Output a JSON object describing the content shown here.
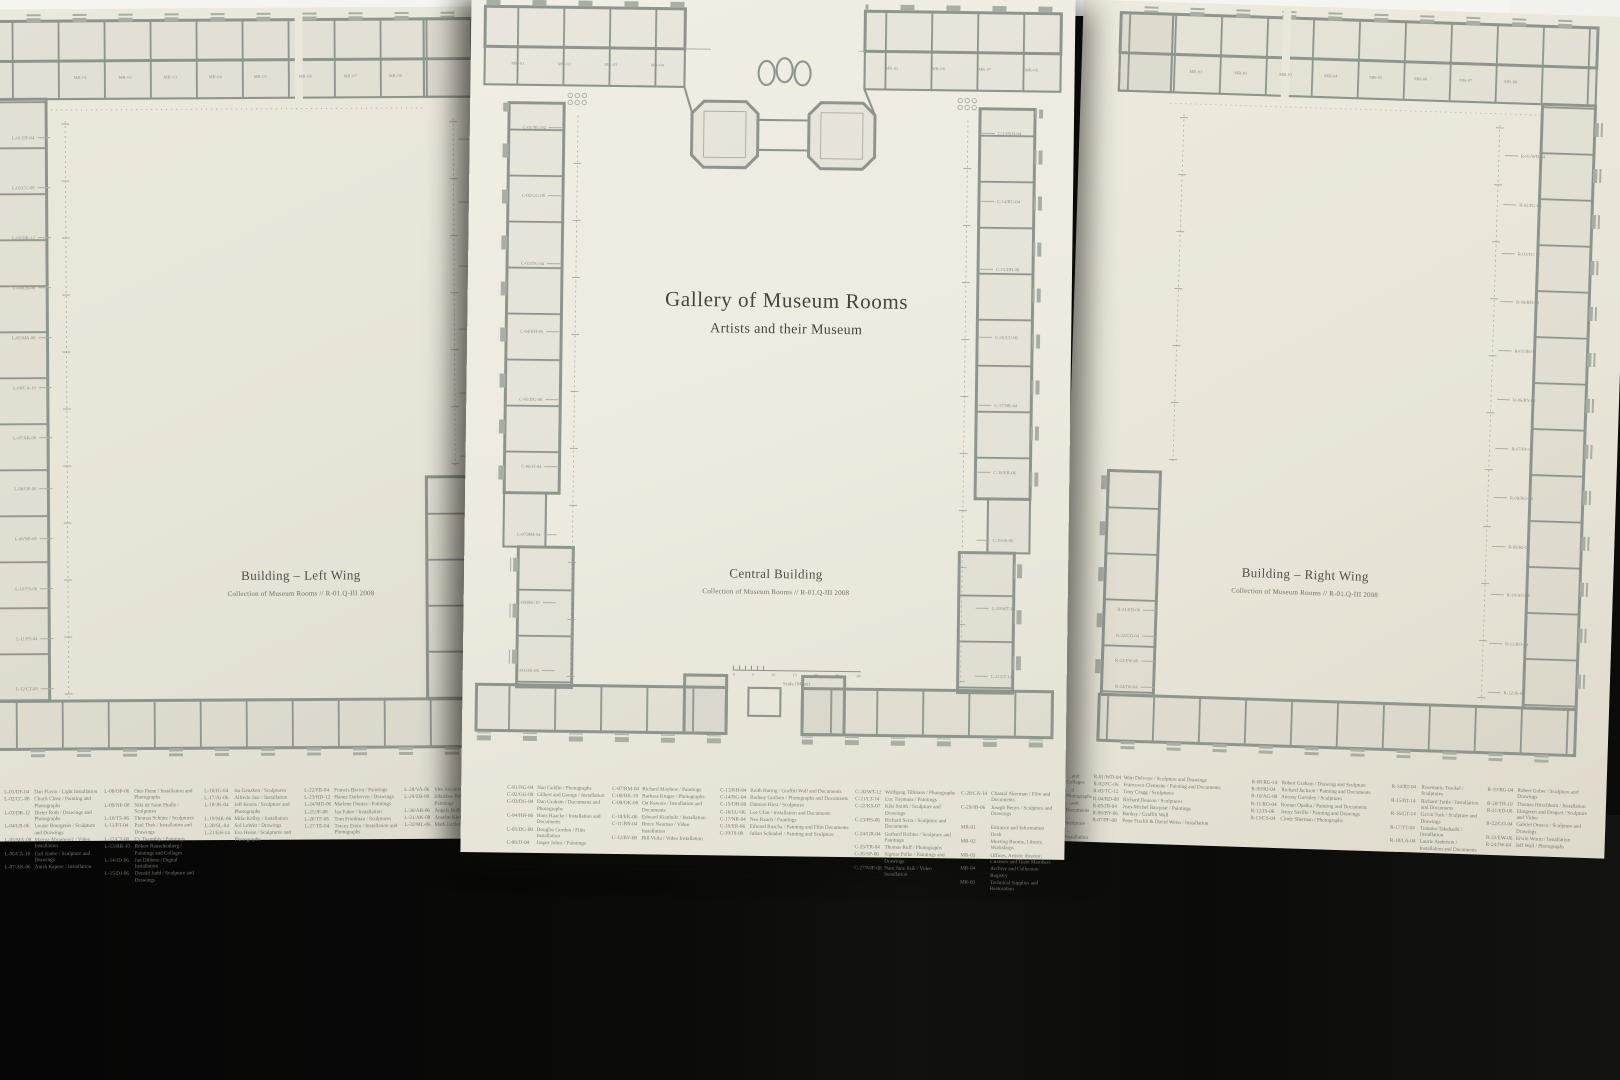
{
  "poster": {
    "title": "Gallery of Museum Rooms",
    "subtitle": "Artists and their Museum"
  },
  "sheets": {
    "left": {
      "caption": "Building – Left Wing",
      "subcaption": "Collection of Museum Rooms // R-01.Q-III 2008",
      "room_labels": [
        "MR-01",
        "MR-02",
        "MR-03",
        "MR-04",
        "MR-05",
        "MR-06",
        "MR-07",
        "MR-08"
      ],
      "edge_labels_left": [
        "L-01/DF-04",
        "L-02/CC-08",
        "L-03/DR-12",
        "L-04/LB-06",
        "L-05/MA-08",
        "L-06/CA-10",
        "L-07/AK-06",
        "L-08/OP-06",
        "L-09/NP-08",
        "L-10/TS-06",
        "L-11/PT-04",
        "L-12/CT-08"
      ],
      "edge_labels_right": [
        "L-16/IG-04",
        "L-17/AJ-06",
        "L-18/JK-04",
        "L-19/MK-06",
        "L-20/SL-04",
        "L-21/EH-14"
      ],
      "legend": {
        "c1": [
          {
            "c": "L-01/DF-04",
            "t": "Dan Flavin / Light Installation"
          },
          {
            "c": "L-02/CC-08",
            "t": "Chuck Close / Painting and Photographs"
          },
          {
            "c": "L-03/DR-12",
            "t": "Dieter Roth / Drawings and Photographs"
          },
          {
            "c": "L-04/LB-06",
            "t": "Louise Bourgeois / Sculpture and Drawings"
          },
          {
            "c": "L-05/MA-08",
            "t": "Marina Abramović / Video Installation"
          },
          {
            "c": "L-06/CA-10",
            "t": "Carl Andre / Sculpture and Drawings"
          },
          {
            "c": "L-07/AK-06",
            "t": "Anish Kapoor / Installation"
          }
        ],
        "c2": [
          {
            "c": "L-08/OP-06",
            "t": "Otto Piene / Installation and Photographs"
          },
          {
            "c": "L-09/NP-08",
            "t": "Niki de Saint Phalle / Sculptures"
          },
          {
            "c": "L-10/TS-06",
            "t": "Thomas Schütte / Sculptures"
          },
          {
            "c": "L-11/PT-04",
            "t": "Paul Thek / Installation and Drawings"
          },
          {
            "c": "L-12/CT-08",
            "t": "Cy Twombly / Paintings"
          },
          {
            "c": "L-13/RR-10",
            "t": "Robert Rauschenberg / Paintings and Collages"
          },
          {
            "c": "L-14/JD-06",
            "t": "Jan Dibbets / Digital Installation"
          },
          {
            "c": "L-15/DJ-06",
            "t": "Donald Judd / Sculpture and Drawings"
          }
        ],
        "c3": [
          {
            "c": "L-16/IG-04",
            "t": "Isa Genzken / Sculptures"
          },
          {
            "c": "L-17/AJ-06",
            "t": "Alfredo Jaar / Installation"
          },
          {
            "c": "L-18/JK-04",
            "t": "Jeff Koons / Sculpture and Photographs"
          },
          {
            "c": "L-19/MK-06",
            "t": "Mike Kelley / Installation"
          },
          {
            "c": "L-20/SL-04",
            "t": "Sol LeWitt / Drawings"
          },
          {
            "c": "L-21/EH-14",
            "t": "Eva Hesse / Sculptures and Photographs"
          }
        ],
        "c4": [
          {
            "c": "L-22/FB-04",
            "t": "Francis Bacon / Paintings"
          },
          {
            "c": "L-23/HD-12",
            "t": "Hanne Darboven / Drawings"
          },
          {
            "c": "L-24/MD-06",
            "t": "Marlene Dumas / Paintings"
          },
          {
            "c": "L-25/JF-08",
            "t": "Jan Fabre / Installation"
          },
          {
            "c": "L-26/TF-06",
            "t": "Tom Friedman / Sculptures"
          },
          {
            "c": "L-27/TE-04",
            "t": "Tracey Emin / Installation and Photographs"
          }
        ],
        "c5": [
          {
            "c": "L-28/VA-06",
            "t": "Vito Acconci / Installation"
          },
          {
            "c": "L-29/ZB-08",
            "t": "Zdzislaw Beksinski / Paintings"
          },
          {
            "c": "L-30/AB-06",
            "t": "Angela Bulloch / Sculptures"
          },
          {
            "c": "L-31/AK-08",
            "t": "Anselm Kiefer / Paintings"
          },
          {
            "c": "L-32/ML-06",
            "t": "Mark Leckey / Installation"
          }
        ]
      }
    },
    "center": {
      "caption": "Central Building",
      "subcaption": "Collection of Museum Rooms // R-01.Q-III 2008",
      "room_labels_left": [
        "MR-01",
        "MR-02",
        "MR-03",
        "MR-04"
      ],
      "room_labels_right": [
        "MR-05",
        "MR-06",
        "MR-07",
        "MR-08"
      ],
      "edge_labels_left": [
        "C-01/NG-04",
        "C-02/GG-08",
        "C-03/DG-04",
        "C-04/HH-06",
        "C-05/DG-08",
        "C-06/JJ-04",
        "C-07/RM-04",
        "C-08/BK-10",
        "C-09/OK-06"
      ],
      "edge_labels_right": [
        "C-13/KH-04",
        "C-14/RG-04",
        "C-15/DH-08",
        "C-16/LU-06",
        "C-17/NR-04",
        "C-18/ER-06",
        "C-19/JS-06",
        "C-20/WT-12",
        "C-21/LT-14"
      ],
      "scale": {
        "label": "Scale (Meter)",
        "ticks": [
          "0",
          "5",
          "10",
          "15",
          "20",
          "30",
          "40"
        ]
      },
      "legend": {
        "c1": [
          {
            "c": "C-01/NG-04",
            "t": "Nan Goldin / Photographs"
          },
          {
            "c": "C-02/GG-08",
            "t": "Gilbert and George / Installation"
          },
          {
            "c": "C-03/DG-04",
            "t": "Dan Graham / Documents and Photographs"
          },
          {
            "c": "C-04/HH-06",
            "t": "Hans Haacke / Installation and Documents"
          },
          {
            "c": "C-05/DG-08",
            "t": "Douglas Gordon / Film Installation"
          },
          {
            "c": "C-06/JJ-04",
            "t": "Jasper Johns / Paintings"
          }
        ],
        "c2": [
          {
            "c": "C-07/RM-04",
            "t": "Richard Mayhew / Paintings"
          },
          {
            "c": "C-08/BK-10",
            "t": "Barbara Kruger / Photographs"
          },
          {
            "c": "C-09/OK-06",
            "t": "On Kawara / Installation and Documents"
          },
          {
            "c": "C-10/EK-06",
            "t": "Edward Kienholz / Installation"
          },
          {
            "c": "C-11/BN-04",
            "t": "Bruce Nauman / Video Installation"
          },
          {
            "c": "C-12/BV-08",
            "t": "Bill Viola / Video Installation"
          }
        ],
        "c3": [
          {
            "c": "C-13/KH-04",
            "t": "Keith Haring / Graffiti Wall and Documents"
          },
          {
            "c": "C-14/RG-04",
            "t": "Rodney Graham / Photographs and Documents"
          },
          {
            "c": "C-15/DH-08",
            "t": "Damien Hirst / Sculptures"
          },
          {
            "c": "C-16/LU-06",
            "t": "Lee Ufan / Installation and Documents"
          },
          {
            "c": "C-17/NR-04",
            "t": "Neo Rauch / Paintings"
          },
          {
            "c": "C-18/ER-06",
            "t": "Edward Ruscha / Painting and Film Documents"
          },
          {
            "c": "C-19/JS-06",
            "t": "Julian Schnabel / Painting and Sculpture"
          }
        ],
        "c4": [
          {
            "c": "C-20/WT-12",
            "t": "Wolfgang Tillmans / Photographs"
          },
          {
            "c": "C-21/LT-14",
            "t": "Luc Tuymans / Paintings"
          },
          {
            "c": "C-22/KS-07",
            "t": "Kiki Smith / Sculpture and Drawings"
          },
          {
            "c": "C-23/RS-06",
            "t": "Richard Serra / Sculpture and Documents"
          },
          {
            "c": "C-24/GR-04",
            "t": "Gerhard Richter / Sculpture and Paintings"
          },
          {
            "c": "C-25/TR-04",
            "t": "Thomas Ruff / Photographs"
          },
          {
            "c": "C-26/SP-06",
            "t": "Sigmar Polke / Paintings and Drawings"
          },
          {
            "c": "C-27/NJP-08",
            "t": "Nam June Paik / Video Installation"
          }
        ],
        "c5": [
          {
            "c": "C-28/CA-14",
            "t": "Chantal Akerman / Film and Documents"
          },
          {
            "c": "C-29/JB-06",
            "t": "Joseph Beuys / Sculpture and Drawings"
          },
          {
            "c": "",
            "t": ""
          },
          {
            "c": "MR-01",
            "t": "Entrance and Information Desk"
          },
          {
            "c": "MR-02",
            "t": "Meeting Rooms, Library, Workshops"
          },
          {
            "c": "MR-03",
            "t": "Offices, Artistic director, Curators and Team Members"
          },
          {
            "c": "MR-04",
            "t": "Archive and Collection Registry"
          },
          {
            "c": "MR-05",
            "t": "Technical Supplies and Restoration"
          }
        ]
      }
    },
    "right": {
      "caption": "Building – Right Wing",
      "subcaption": "Collection of Museum Rooms // R-01.Q-III 2008",
      "room_labels": [
        "MR-01",
        "MR-02",
        "MR-03",
        "MR-04",
        "MR-05",
        "MR-06",
        "MR-07",
        "MR-08"
      ],
      "edge_labels_right": [
        "R-01/WD-04",
        "R-02/FC-06",
        "R-03/TC-12",
        "R-04/RD-08",
        "R-05/JB-04",
        "R-06/BY-06",
        "R-07/PF-08",
        "R-08/RG-14",
        "R-09/RJ-04",
        "R-10/AG-08",
        "R-11/RO-04",
        "R-12/JS-06"
      ],
      "edge_labels_left": [
        "R-21/ED-06",
        "R-22/GO-04",
        "R-23/EW-06",
        "R-24/JW-04"
      ],
      "legend": {
        "c0": [
          "…and Collages",
          "…d Photographs",
          "…and Documents",
          "…Sculpture",
          "…Installation"
        ],
        "c1": [
          {
            "c": "R-01/WD-04",
            "t": "Wim Delvoye / Sculpture and Drawings"
          },
          {
            "c": "R-02/FC-06",
            "t": "Francesco Clemente / Painting and Documents"
          },
          {
            "c": "R-03/TC-12",
            "t": "Tony Cragg / Sculptures"
          },
          {
            "c": "R-04/RD-08",
            "t": "Richard Deacon / Sculptures"
          },
          {
            "c": "R-05/JB-04",
            "t": "Jean-Michel Basquiat / Paintings"
          },
          {
            "c": "R-06/BY-06",
            "t": "Banksy / Graffiti Wall"
          },
          {
            "c": "R-07/PF-08",
            "t": "Peter Fischli & David Weiss / Installation"
          }
        ],
        "c2": [
          {
            "c": "R-08/RG-14",
            "t": "Robert Graham / Drawing and Sculpture"
          },
          {
            "c": "R-09/RJ-04",
            "t": "Richard Jackson / Painting and Documents"
          },
          {
            "c": "R-10/AG-08",
            "t": "Antony Gormley / Sculptures"
          },
          {
            "c": "R-11/RO-04",
            "t": "Roman Opalka / Painting and Documents"
          },
          {
            "c": "R-12/JS-06",
            "t": "Jenny Saville / Painting and Drawings"
          },
          {
            "c": "R-13/CS-04",
            "t": "Cindy Sherman / Photographs"
          }
        ],
        "c3": [
          {
            "c": "R-14/RT-04",
            "t": "Rosemarie Trockel / Sculptures"
          },
          {
            "c": "R-15/RT-14",
            "t": "Richard Tuttle / Installation and Documents"
          },
          {
            "c": "R-16/GT-14",
            "t": "Gavin Turk / Sculpture and Drawings"
          },
          {
            "c": "R-17/TT-04",
            "t": "Tomoko Takahashi / Installation"
          },
          {
            "c": "R-18/LA-04",
            "t": "Laurie Anderson / Installation and Documents"
          }
        ],
        "c4": [
          {
            "c": "R-19/RG-04",
            "t": "Robert Gober / Sculpture and Drawings"
          },
          {
            "c": "R-20/TH-10",
            "t": "Thomas Hirschhorn / Installation"
          },
          {
            "c": "R-21/ED-06",
            "t": "Elmgreen and Dragset / Sculpture and Video"
          },
          {
            "c": "R-22/GO-04",
            "t": "Gabriel Orozco / Sculpture and Drawings"
          },
          {
            "c": "R-23/EW-06",
            "t": "Erwin Wurm / Installation"
          },
          {
            "c": "R-24/JW-04",
            "t": "Jeff Wall / Photographs"
          }
        ]
      }
    }
  }
}
